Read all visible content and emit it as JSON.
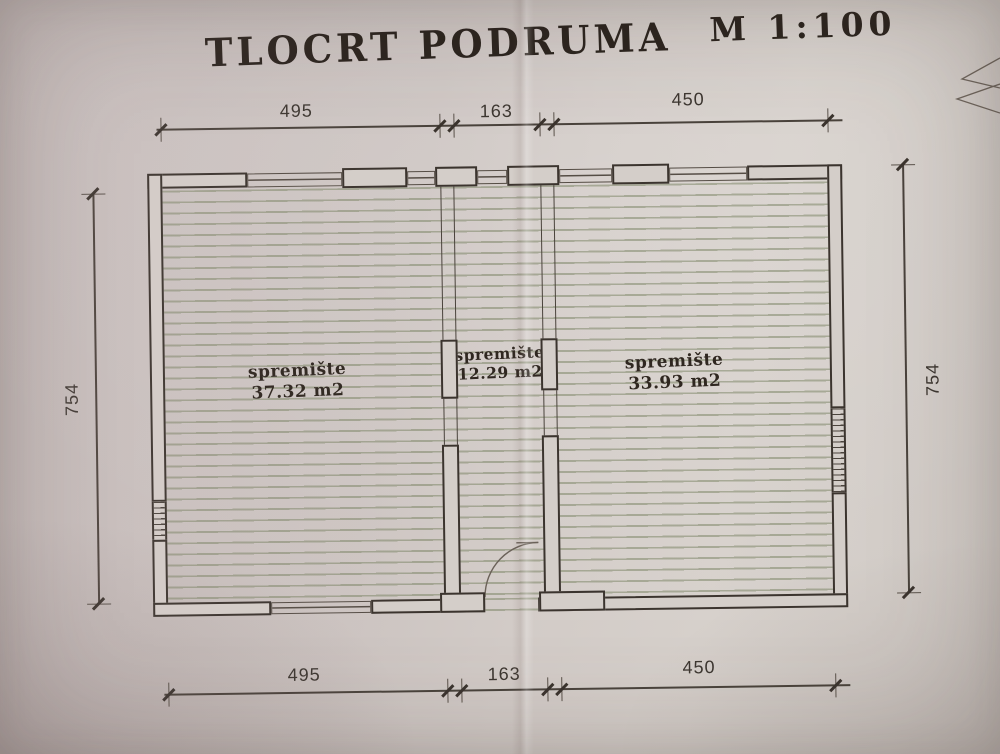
{
  "title": {
    "main": "TLOCRT PODRUMA",
    "scale": "M 1:100"
  },
  "rooms": [
    {
      "name": "spremište",
      "area": "37.32 m2"
    },
    {
      "name": "spremište",
      "area": "12.29 m2"
    },
    {
      "name": "spremište",
      "area": "33.93 m2"
    }
  ],
  "dimensions": {
    "top": [
      "495",
      "163",
      "450"
    ],
    "bottom": [
      "495",
      "163",
      "450"
    ],
    "left": "754",
    "right": "754"
  }
}
